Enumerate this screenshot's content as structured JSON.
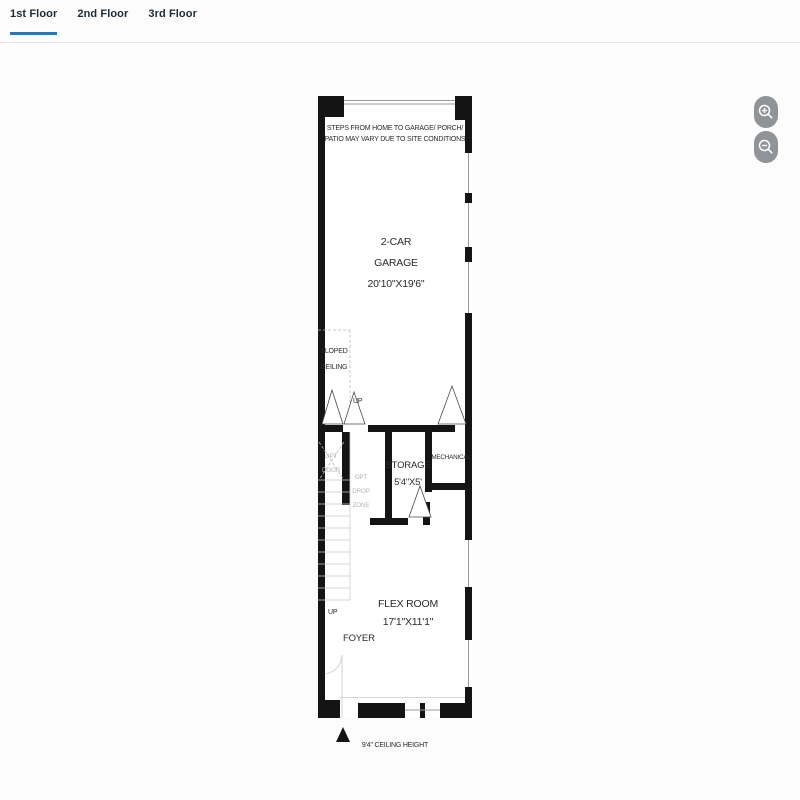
{
  "colors": {
    "accent_blue": "#2878b5",
    "divider_gray": "#e3e3e3",
    "wall_black": "#141414",
    "zoom_button_gray": "#8f9499",
    "text_dark": "#2b2b2b",
    "text_light": "#b5b5b5"
  },
  "tabs": [
    {
      "label": "1st Floor",
      "active": true
    },
    {
      "label": "2nd Floor",
      "active": false
    },
    {
      "label": "3rd Floor",
      "active": false
    }
  ],
  "zoom_controls": {
    "zoom_in": "zoom in",
    "zoom_out": "zoom out"
  },
  "floorplan": {
    "disclaimer_line1": "STEPS FROM HOME TO GARAGE/ PORCH/",
    "disclaimer_line2": "PATIO MAY VARY DUE TO SITE CONDITIONS",
    "garage_line1": "2-CAR",
    "garage_line2": "GARAGE",
    "garage_dims": "20'10\"X19'6\"",
    "sloped_line1": "SLOPED",
    "sloped_line2": "CEILING",
    "up_garage": "UP",
    "opt_door_line1": "OPT",
    "opt_door_line2": "DOOR",
    "opt_drop_line1": "OPT",
    "opt_drop_line2": "DROP",
    "opt_drop_line3": "ZONE",
    "storage_name": "STORAGE",
    "storage_dims": "5'4\"X5'",
    "mechanical": "MECHANICAL",
    "flex_name": "FLEX ROOM",
    "flex_dims": "17'1\"X11'1\"",
    "up_foyer": "UP",
    "foyer": "FOYER",
    "ceiling_height": "9'4\" CEILING HEIGHT"
  }
}
